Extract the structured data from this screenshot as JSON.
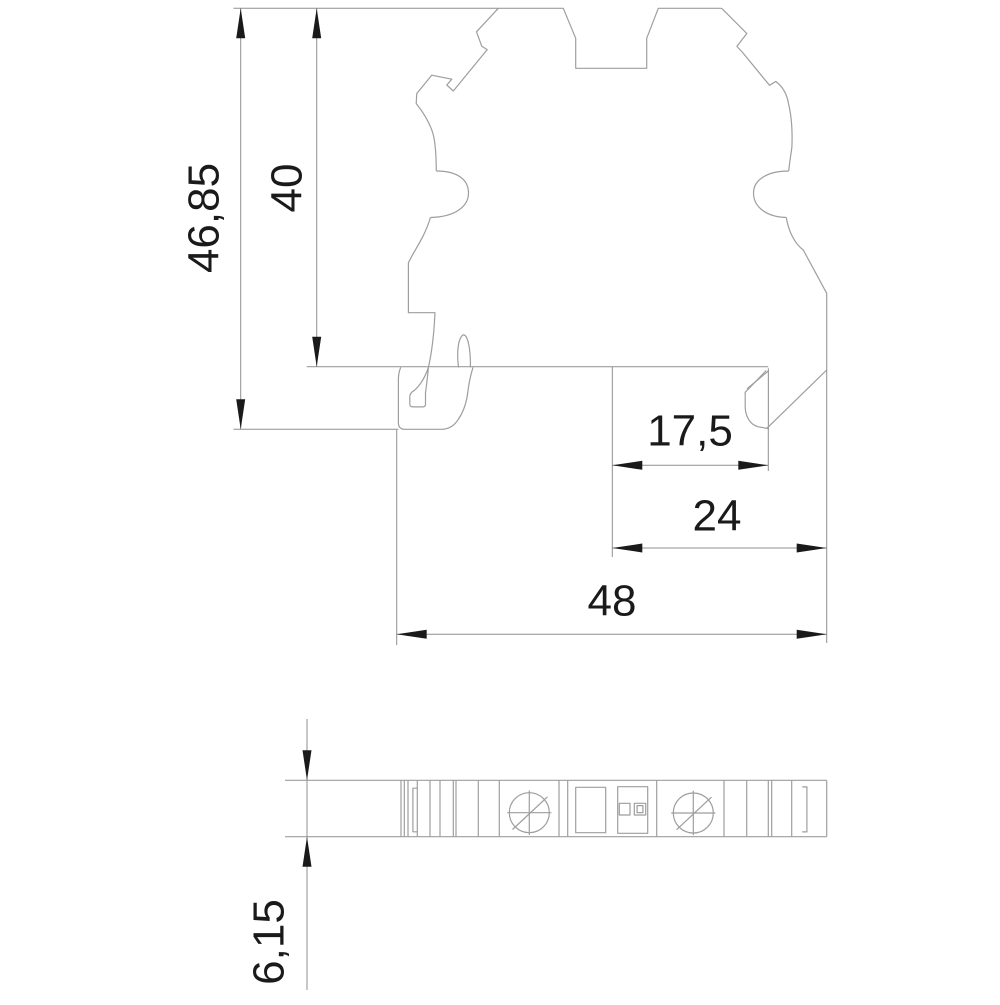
{
  "drawing": {
    "type": "technical-dimension-drawing",
    "colors": {
      "background": "#ffffff",
      "object_line": "#9e9e9e",
      "dimension_line": "#8f8f8f",
      "text_and_arrows": "#1a1a1a"
    },
    "dimensions": {
      "overall_height": {
        "label": "46,85"
      },
      "body_height": {
        "label": "40"
      },
      "rail_offset": {
        "label": "17,5"
      },
      "lower_width": {
        "label": "24"
      },
      "overall_width": {
        "label": "48"
      },
      "thickness": {
        "label": "6,15"
      }
    }
  }
}
